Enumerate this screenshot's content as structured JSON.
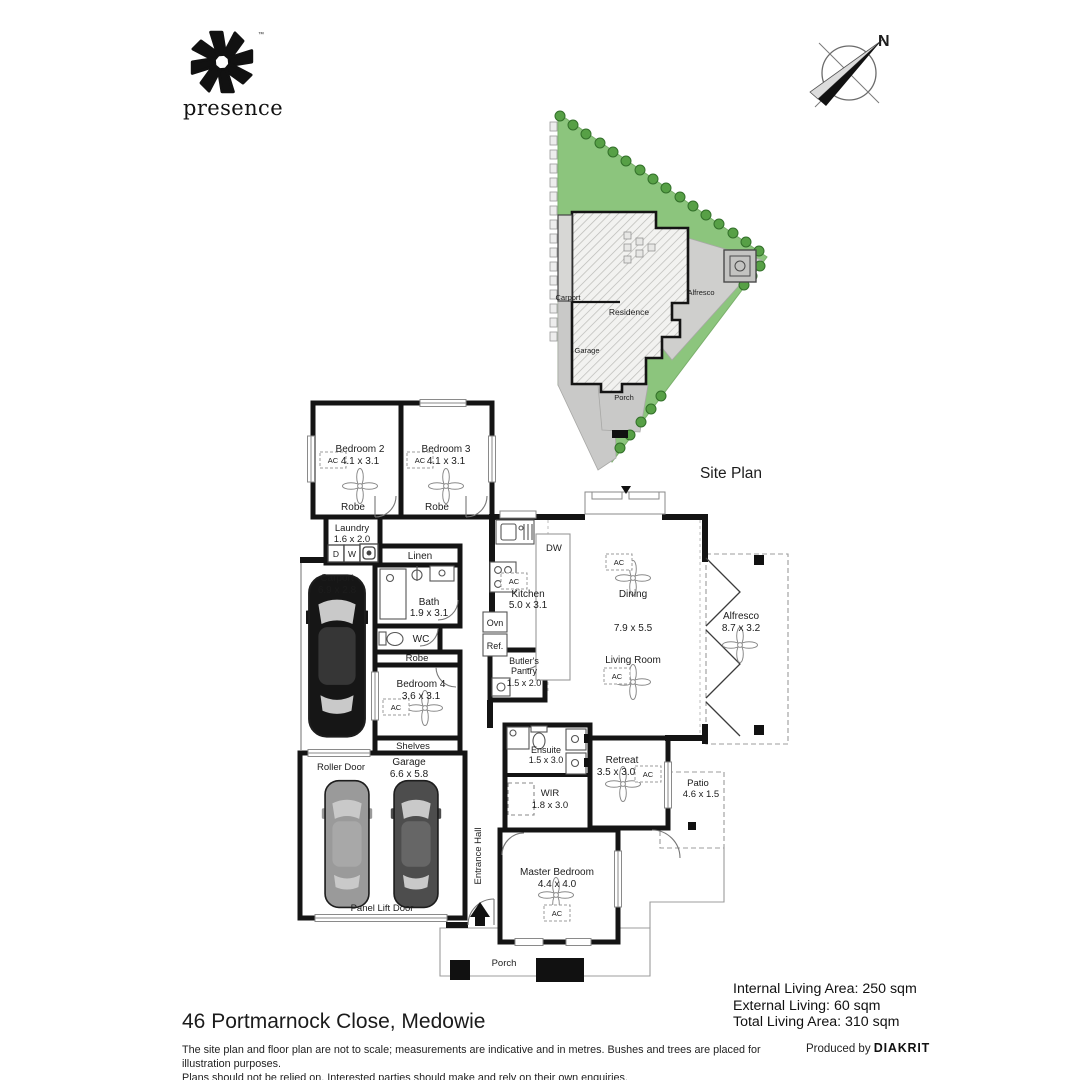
{
  "header": {
    "logo_text": "presence",
    "compass_n": "N"
  },
  "site": {
    "title": "Site Plan",
    "carport": "Carport",
    "residence": "Residence",
    "garage": "Garage",
    "porch": "Porch",
    "alfresco": "Alfresco"
  },
  "fp": {
    "bedroom2": "Bedroom 2",
    "bedroom2_dims": "4.1 x 3.1",
    "bedroom3": "Bedroom 3",
    "bedroom3_dims": "4.1 x 3.1",
    "robe": "Robe",
    "laundry": "Laundry",
    "laundry_dims": "1.6 x 2.0",
    "linen": "Linen",
    "bath": "Bath",
    "bath_dims": "1.9 x 3.1",
    "wc": "WC",
    "bedroom4": "Bedroom 4",
    "bedroom4_dims": "3.6 x 3.1",
    "shelves": "Shelves",
    "carport": "Carport",
    "carport_dims": "6.9 x 2.8",
    "roller_door": "Roller Door",
    "garage": "Garage",
    "garage_dims": "6.6 x 5.8",
    "panel_lift_door": "Panel Lift Door",
    "entrance_hall": "Entrance Hall",
    "porch": "Porch",
    "kitchen": "Kitchen",
    "kitchen_dims": "5.0 x 3.1",
    "dw": "DW",
    "ovn": "Ovn",
    "ref": "Ref.",
    "butlers_1": "Butler's",
    "butlers_2": "Pantry",
    "butlers_dims": "1.5 x 2.0",
    "dining": "Dining",
    "living_room": "Living Room",
    "living_dims": "7.9 x 5.5",
    "alfresco": "Alfresco",
    "alfresco_dims": "8.7 x 3.2",
    "retreat": "Retreat",
    "retreat_dims": "3.5 x 3.0",
    "patio": "Patio",
    "patio_dims": "4.6 x 1.5",
    "ensuite": "Ensuite",
    "ensuite_dims": "1.5 x 3.0",
    "wir": "WIR",
    "wir_dims": "1.8 x 3.0",
    "master": "Master Bedroom",
    "master_dims": "4.4 x 4.0",
    "ac": "AC",
    "d": "D",
    "w": "W"
  },
  "footer": {
    "address": "46 Portmarnock Close, Medowie",
    "disclaimer_line1": "The site plan and floor plan are not to scale; measurements are indicative and in metres. Bushes and trees are placed for illustration purposes.",
    "disclaimer_line2": "Plans should not be relied on. Interested parties should make and rely on their own enquiries.",
    "internal_area": "Internal Living Area: 250 sqm",
    "external_area": "External Living: 60 sqm",
    "total_area": "Total Living Area: 310 sqm",
    "produced_by": "Produced by",
    "producer": "DIAKRIT"
  }
}
